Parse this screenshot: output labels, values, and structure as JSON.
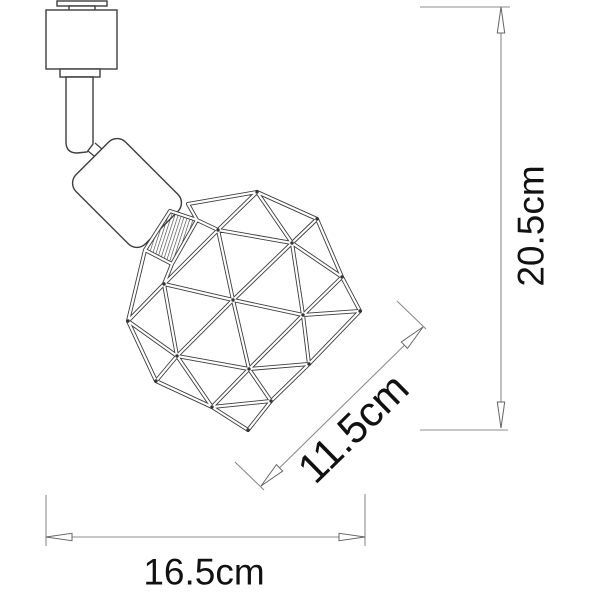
{
  "figure": {
    "kind": "product-dimension-line-drawing",
    "subject": "track-spotlight-with-geometric-wire-cage"
  },
  "dimensions": {
    "height": "20.5cm",
    "cage_diagonal": "11.5cm",
    "base_width": "16.5cm"
  },
  "colors": {
    "background": "#ffffff",
    "drawing_line": "#3d3d3d",
    "dimension_line": "#8c8c8c",
    "label_text": "#111111"
  }
}
